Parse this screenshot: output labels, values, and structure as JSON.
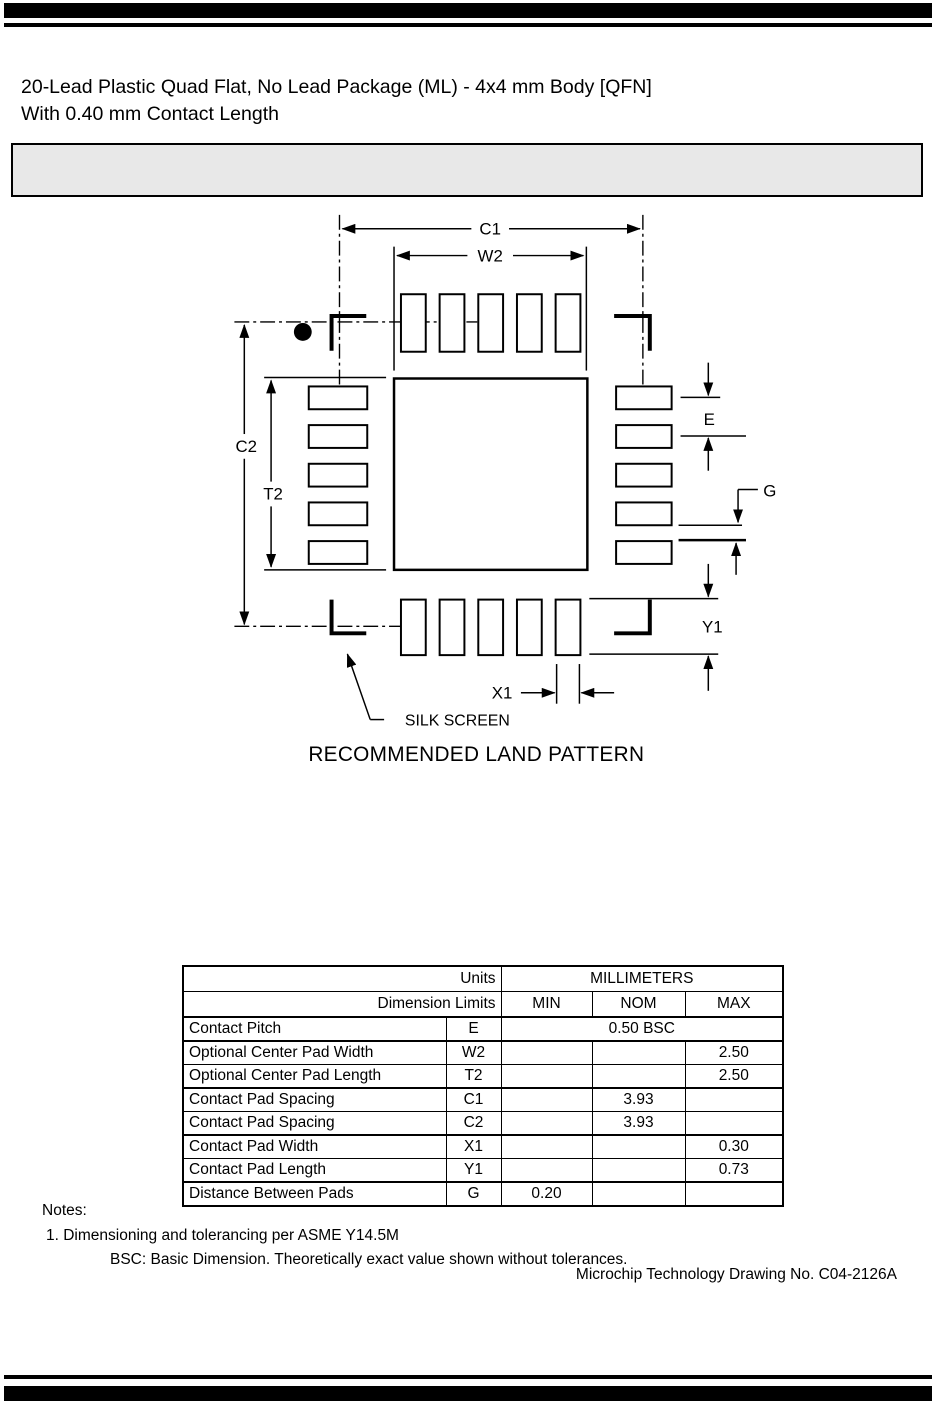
{
  "header": {
    "title_line1": "20-Lead Plastic Quad Flat, No Lead Package (ML) - 4x4 mm Body [QFN]",
    "title_line2": "With 0.40 mm Contact Length"
  },
  "drawing": {
    "caption": "RECOMMENDED LAND PATTERN",
    "labels": {
      "c1": "C1",
      "w2": "W2",
      "c2": "C2",
      "t2": "T2",
      "e": "E",
      "g": "G",
      "y1": "Y1",
      "x1": "X1",
      "silk_screen": "SILK SCREEN"
    }
  },
  "table": {
    "units_label": "Units",
    "units_value": "MILLIMETERS",
    "limits_label": "Dimension Limits",
    "col_min": "MIN",
    "col_nom": "NOM",
    "col_max": "MAX",
    "rows": [
      {
        "param": "Contact Pitch",
        "symbol": "E",
        "min": "",
        "nom": "0.50 BSC",
        "max": ""
      },
      {
        "param": "Optional Center Pad Width",
        "symbol": "W2",
        "min": "",
        "nom": "",
        "max": "2.50"
      },
      {
        "param": "Optional Center Pad Length",
        "symbol": "T2",
        "min": "",
        "nom": "",
        "max": "2.50"
      },
      {
        "param": "Contact Pad Spacing",
        "symbol": "C1",
        "min": "",
        "nom": "3.93",
        "max": ""
      },
      {
        "param": "Contact Pad Spacing",
        "symbol": "C2",
        "min": "",
        "nom": "3.93",
        "max": ""
      },
      {
        "param": "Contact Pad Width",
        "symbol": "X1",
        "min": "",
        "nom": "",
        "max": "0.30"
      },
      {
        "param": "Contact Pad Length",
        "symbol": "Y1",
        "min": "",
        "nom": "",
        "max": "0.73"
      },
      {
        "param": "Distance Between Pads",
        "symbol": "G",
        "min": "0.20",
        "nom": "",
        "max": ""
      }
    ]
  },
  "notes": {
    "heading": "Notes:",
    "note1": "1. Dimensioning and tolerancing per ASME Y14.5M",
    "note2": "BSC: Basic Dimension. Theoretically exact value shown without tolerances."
  },
  "footer": {
    "drawing_number": "Microchip Technology Drawing No. C04-2126A"
  },
  "colors": {
    "ink": "#000000",
    "band_fill": "#e8e8e8"
  }
}
